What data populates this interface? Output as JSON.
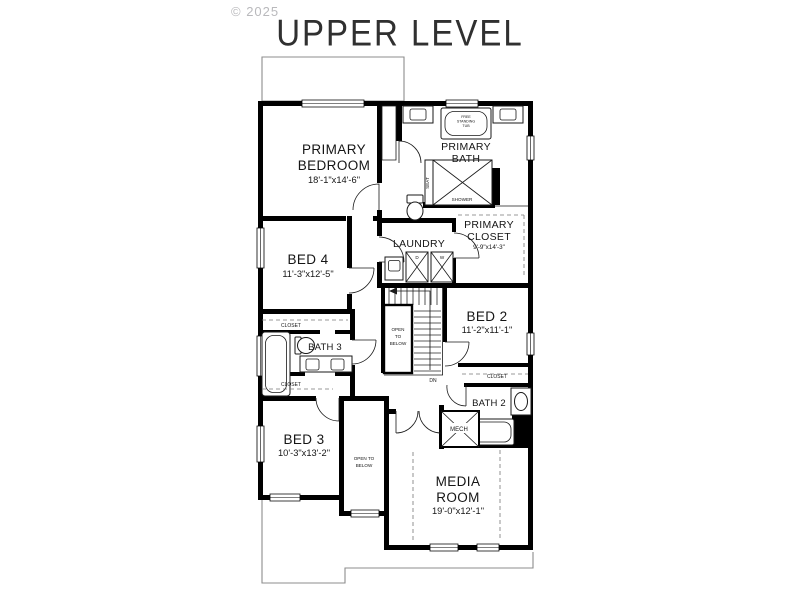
{
  "page": {
    "watermark": "© 2025",
    "title": "UPPER LEVEL"
  },
  "rooms": {
    "primary_bedroom": {
      "name1": "PRIMARY",
      "name2": "BEDROOM",
      "dims": "18'-1\"x14'-6\""
    },
    "primary_bath": {
      "name1": "PRIMARY",
      "name2": "BATH"
    },
    "primary_closet": {
      "name1": "PRIMARY",
      "name2": "CLOSET",
      "dims": "9'-9\"x14'-3\""
    },
    "laundry": {
      "name": "LAUNDRY"
    },
    "bed2": {
      "name": "BED 2",
      "dims": "11'-2\"x11'-1\""
    },
    "bed3": {
      "name": "BED 3",
      "dims": "10'-3\"x13'-2\""
    },
    "bed4": {
      "name": "BED 4",
      "dims": "11'-3\"x12'-5\""
    },
    "bath2": {
      "name": "BATH 2"
    },
    "bath3": {
      "name": "BATH 3"
    },
    "media_room": {
      "name1": "MEDIA",
      "name2": "ROOM",
      "dims": "19'-0\"x12'-1\""
    },
    "mech": {
      "name": "MECH"
    }
  },
  "fixtures": {
    "tub_line1": "FREE",
    "tub_line2": "STANDING",
    "tub_line3": "TUB",
    "seat": "SEAT",
    "shower": "SHOWER",
    "dryer": "D",
    "washer": "W"
  },
  "labels": {
    "closet": "CLOSET",
    "stair_open1": "OPEN",
    "stair_open2": "TO",
    "stair_open3": "BELOW",
    "hall_open1": "OPEN TO",
    "hall_open2": "BELOW",
    "down": "DN"
  },
  "colors": {
    "wall": "#000000",
    "thin_outline": "#8d8d8d",
    "text": "#151515",
    "watermark": "#b9b9bc"
  }
}
